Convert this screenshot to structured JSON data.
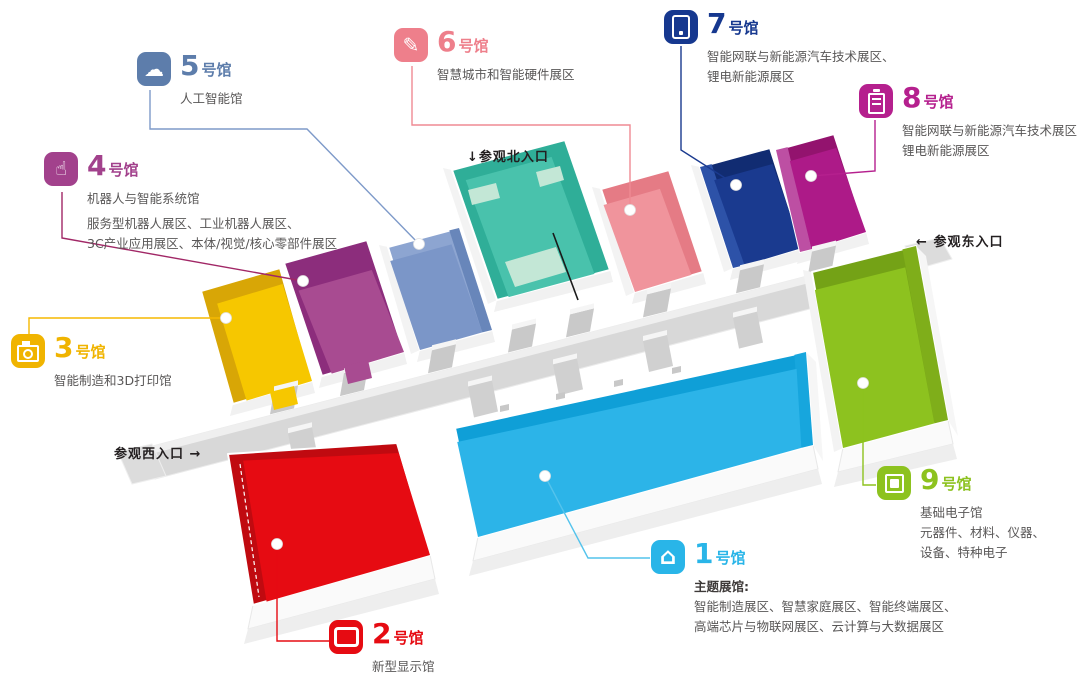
{
  "halls": {
    "h1": {
      "num": "1",
      "suffix": "号馆",
      "name": "主题展馆:",
      "icon": "home-icon",
      "color": "#29b5e8",
      "floor": "#2cb4e8",
      "dark": "#0f9fd7",
      "line": "#54c3ec",
      "lines": [
        "智能制造展区、智慧家庭展区、智能终端展区、",
        "高端芯片与物联网展区、云计算与大数据展区"
      ]
    },
    "h2": {
      "num": "2",
      "suffix": "号馆",
      "name": "新型显示馆",
      "icon": "display-icon",
      "color": "#e60b12",
      "floor": "#e60b12",
      "dark": "#c00a10",
      "line": "#e60b12",
      "lines": []
    },
    "h3": {
      "num": "3",
      "suffix": "号馆",
      "name": "智能制造和3D打印馆",
      "icon": "printer-icon",
      "color": "#f0b400",
      "floor": "#f6c700",
      "dark": "#d8a606",
      "line": "#f5b800",
      "lines": []
    },
    "h4": {
      "num": "4",
      "suffix": "号馆",
      "name": "机器人与智能系统馆",
      "icon": "hand-icon",
      "color": "#a2418c",
      "floor": "#a84b91",
      "dark": "#8c2d7c",
      "line": "#a12766",
      "lines": [
        "服务型机器人展区、工业机器人展区、",
        "3C产业应用展区、本体/视觉/核心零部件展区"
      ]
    },
    "h5": {
      "num": "5",
      "suffix": "号馆",
      "name": "人工智能馆",
      "icon": "brain-icon",
      "color": "#5d7dab",
      "floor": "#7b96c8",
      "dark": "#8da5d1",
      "line": "#7e9ac9",
      "lines": []
    },
    "h6": {
      "num": "6",
      "suffix": "号馆",
      "name": "智慧城市和智能硬件展区",
      "icon": "pen-icon",
      "color": "#ee7f8b",
      "floor": "#f0949c",
      "dark": "#e57b85",
      "line": "#ef8a93",
      "lines": []
    },
    "h7": {
      "num": "7",
      "suffix": "号馆",
      "name": "",
      "icon": "device-icon",
      "color": "#16388f",
      "floor": "#1a3a8f",
      "dark": "#112c72",
      "line": "#1a3a8f",
      "lines": [
        "智能网联与新能源汽车技术展区、",
        "锂电新能源展区"
      ]
    },
    "h8": {
      "num": "8",
      "suffix": "号馆",
      "name": "",
      "icon": "battery-icon",
      "color": "#b5208e",
      "floor": "#ad1a88",
      "dark": "#93136e",
      "line": "#b5208e",
      "lines": [
        "智能网联与新能源汽车技术展区",
        "锂电新能源展区"
      ]
    },
    "h9": {
      "num": "9",
      "suffix": "号馆",
      "name": "基础电子馆",
      "icon": "chip-icon",
      "color": "#8dc21f",
      "floor": "#8dc21f",
      "dark": "#74a216",
      "line": "#8dc21f",
      "lines": [
        "元器件、材料、仪器、",
        "设备、特种电子"
      ]
    }
  },
  "north_hall": {
    "floor": "#49c2ac",
    "dark": "#2fae98",
    "booth": "#c3e7d6",
    "wall_east": "#23a38c"
  },
  "entrances": {
    "north": {
      "label": "参观北入口",
      "arrow": "↓"
    },
    "east": {
      "label": "参观东入口",
      "arrow": "←"
    },
    "west": {
      "label": "参观西入口",
      "arrow": "→"
    }
  },
  "corridor": {
    "color": "#d8d8d8",
    "highlight": "#efefef",
    "stub": "#c9c9c9"
  }
}
